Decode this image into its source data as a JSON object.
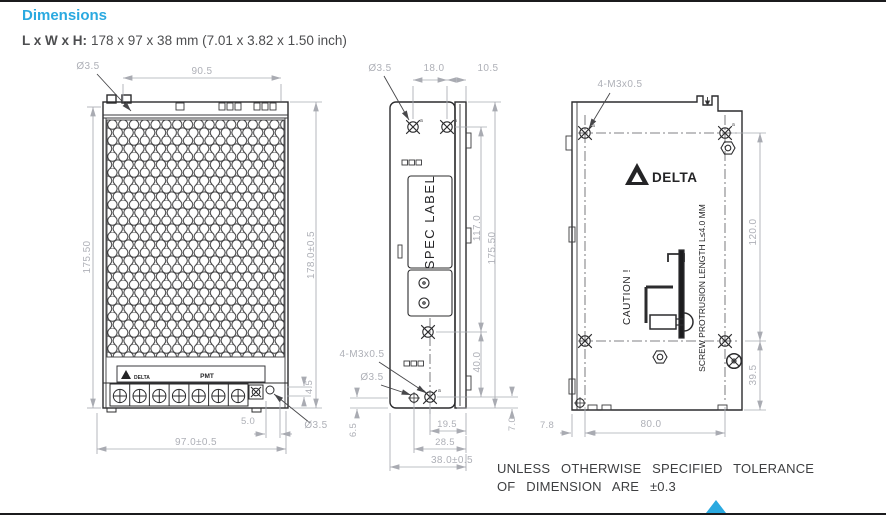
{
  "header": {
    "title": "Dimensions",
    "size_label": "L x W x H:",
    "size_value": "178 x 97 x 38 mm (7.01 x 3.82 x 1.50 inch)"
  },
  "front_view": {
    "top_hole": "Ø3.5",
    "top_width": "90.5",
    "left_height": "175.50",
    "right_height": "178.0±0.5",
    "bottom_width": "97.0±0.5",
    "adj_offset": "5.0",
    "adj_height": "4.5",
    "bottom_hole": "Ø3.5",
    "brand": "DELTA",
    "pot_label": "PMT"
  },
  "side_view": {
    "top_hole": "Ø3.5",
    "screw_pitch": "18.0",
    "top_offset": "10.5",
    "spec_label": "SPEC LABEL",
    "screw_span": "117.0",
    "height": "175.50",
    "lower_screw_span": "40.0",
    "bottom_offset": "7.0",
    "thread_callout": "4-M3x0.5",
    "bottom_hole": "Ø3.5",
    "foot_height": "6.5",
    "hole_pitch_1": "19.5",
    "hole_pitch_2": "28.5",
    "depth": "38.0±0.5",
    "screw_mark": "a"
  },
  "rear_view": {
    "thread_callout": "4-M3x0.5",
    "brand": "DELTA",
    "caution": "CAUTION !",
    "screw_note": "SCREW PROTRUSION LENGTH L≤4.0 MM",
    "screw_span_v": "120.0",
    "bottom_span": "39.5",
    "edge_offset": "7.8",
    "screw_span_h": "80.0",
    "screw_mark": "a"
  },
  "footer": {
    "note_line1": "UNLESS OTHERWISE SPECIFIED TOLERANCE",
    "note_line2": "OF DIMENSION ARE ±0.3"
  },
  "colors": {
    "accent": "#2aa9e0",
    "dim_text": "#aeb0b7",
    "line": "#2c2c2e"
  }
}
